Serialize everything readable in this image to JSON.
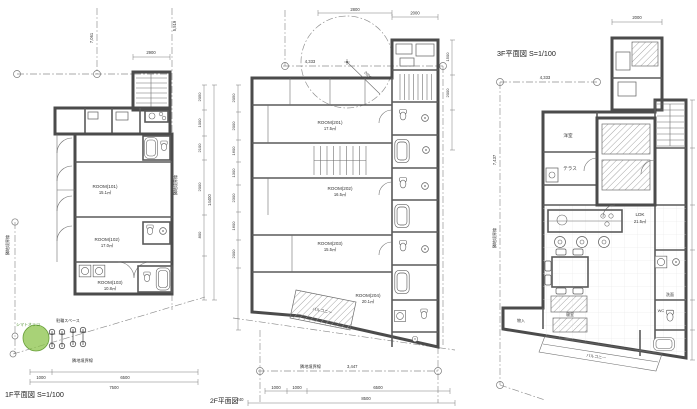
{
  "f1": {
    "title": "1F平面図 S=1/100",
    "rooms": [
      {
        "n": "ROOM(101)",
        "a": "15.1㎡"
      },
      {
        "n": "ROOM(102)",
        "a": "17.0㎡"
      },
      {
        "n": "ROOM(103)",
        "a": "10.8㎡"
      }
    ],
    "tree": "シマトネリコ",
    "bike": "駐輪スペース",
    "bnd_left": "隣地境界線",
    "bnd_bottom": "隣地境界線",
    "bnd_right": "隣地境界線",
    "dim_left_v": "7,061",
    "dim_right_v": "5,519",
    "dim_top": "2900",
    "dim_b1": "1000",
    "dim_b2": "6500",
    "dim_btotal": "7500",
    "chain": [
      "2050",
      "1000",
      "2100",
      "2000",
      "800"
    ],
    "chain_total": "14400"
  },
  "f2": {
    "title": "2F平面図",
    "rooms": [
      {
        "n": "ROOM(201)",
        "a": "17.5㎡"
      },
      {
        "n": "ROOM(202)",
        "a": "16.5㎡"
      },
      {
        "n": "ROOM(203)",
        "a": "15.5㎡"
      },
      {
        "n": "ROOM(204)",
        "a": "20.1㎡"
      }
    ],
    "balcony": "バルコニー",
    "bnd": "隣地境界線",
    "bnd_len": "3,447",
    "dim_top1": "2800",
    "dim_top2": "2000",
    "dim_radius": "2000",
    "dim_left_h": "4,333",
    "chain_left": [
      "2050",
      "2000",
      "1600",
      "1300",
      "2300",
      "1600",
      "2000"
    ],
    "chain_right": [
      "1500",
      "2000"
    ],
    "dim_b1": "1000",
    "dim_b2": "1000",
    "dim_b3": "6500",
    "dim_b4": "240",
    "dim_btotal": "8500"
  },
  "f3": {
    "title": "3F平面図 S=1/100",
    "rooms": [
      {
        "n": "洋室"
      },
      {
        "n": "テラス"
      },
      {
        "n": "LDK",
        "a": "21.5㎡"
      },
      {
        "n": "寝室"
      },
      {
        "n": "洗面"
      },
      {
        "n": "WC"
      },
      {
        "n": "物入"
      }
    ],
    "balcony": "バルコニー",
    "bnd_left": "隣地境界線",
    "dim_left_v": "7,437",
    "dim_top": "2000",
    "dim_span": "4,333"
  }
}
